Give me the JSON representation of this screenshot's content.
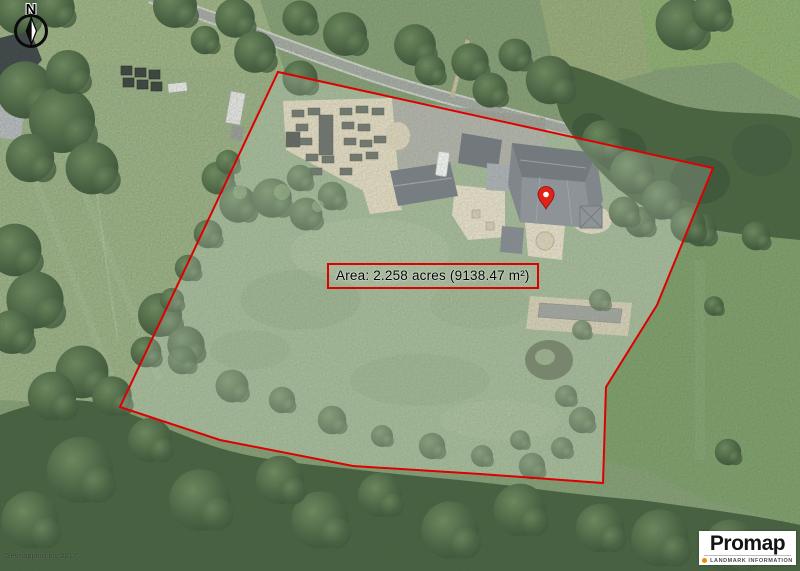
{
  "compass": {
    "letter": "N"
  },
  "area_label": {
    "text": "Area: 2.258 acres (9138.47 m²)"
  },
  "attribution": {
    "text": "Getmapping plc 2017"
  },
  "logo": {
    "brand": "Promap",
    "tagline": "LANDMARK INFORMATION",
    "dot_color": "#f08c00"
  },
  "boundary": {
    "points": "278,72 713,168 657,305 606,387 603,483 480,474 353,466 220,440 120,407",
    "color": "#dd0000"
  },
  "selection_overlay": {
    "fill_opacity": "0.17"
  },
  "pin": {
    "transform": "translate(546,209)",
    "color": "#e02318"
  }
}
